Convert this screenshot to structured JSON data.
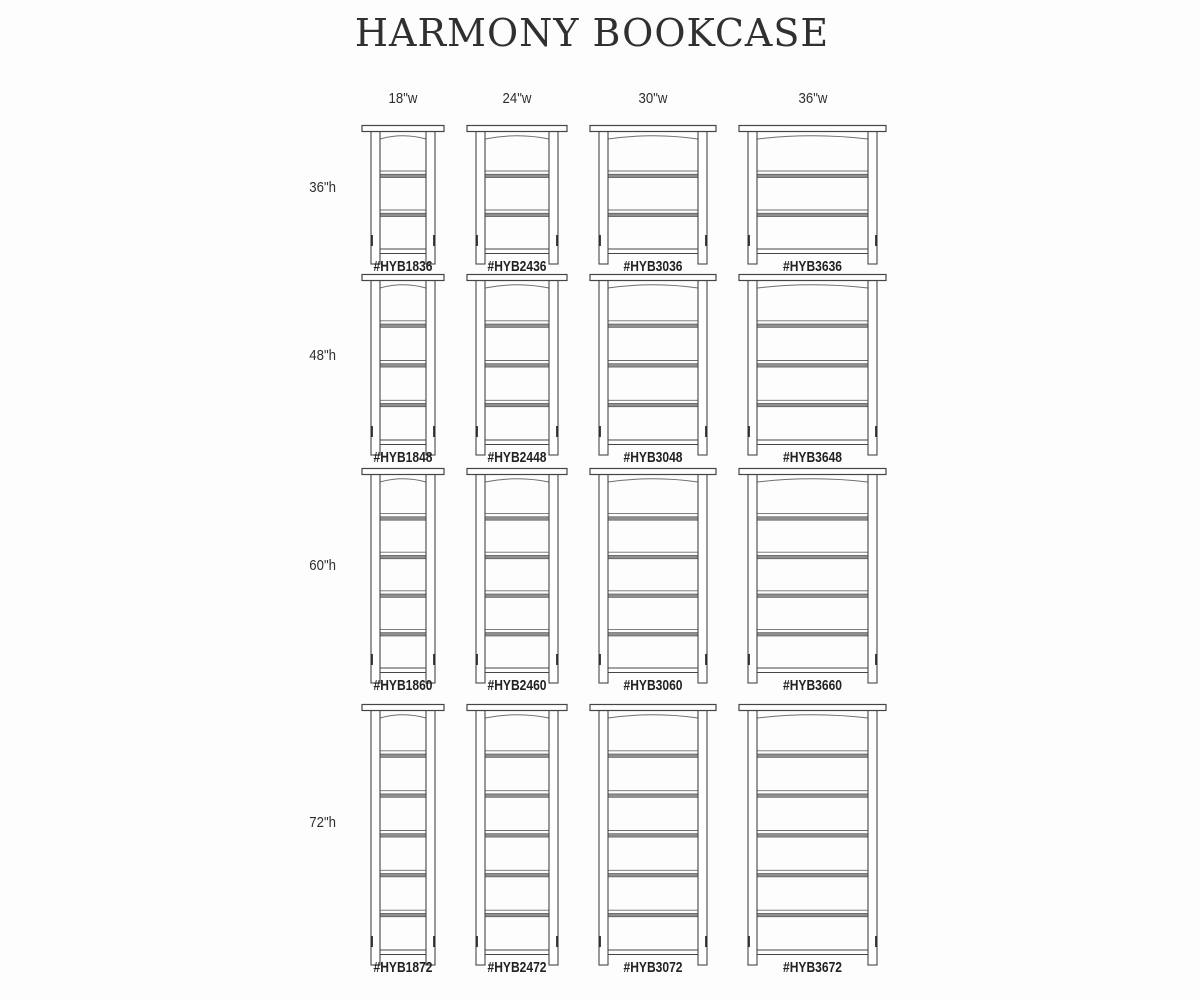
{
  "title": "HARMONY BOOKCASE",
  "grid": {
    "columns": [
      {
        "label": "18\"w",
        "width_in": 18
      },
      {
        "label": "24\"w",
        "width_in": 24
      },
      {
        "label": "30\"w",
        "width_in": 30
      },
      {
        "label": "36\"w",
        "width_in": 36
      }
    ],
    "rows": [
      {
        "label": "36\"h",
        "height_in": 36,
        "shelf_count": 2
      },
      {
        "label": "48\"h",
        "height_in": 48,
        "shelf_count": 3
      },
      {
        "label": "60\"h",
        "height_in": 60,
        "shelf_count": 4
      },
      {
        "label": "72\"h",
        "height_in": 72,
        "shelf_count": 5
      }
    ],
    "models": [
      [
        "#HYB1836",
        "#HYB2436",
        "#HYB3036",
        "#HYB3636"
      ],
      [
        "#HYB1848",
        "#HYB2448",
        "#HYB3048",
        "#HYB3648"
      ],
      [
        "#HYB1860",
        "#HYB2460",
        "#HYB3060",
        "#HYB3660"
      ],
      [
        "#HYB1872",
        "#HYB2472",
        "#HYB3072",
        "#HYB3672"
      ]
    ]
  },
  "colors": {
    "line": "#454545",
    "light_line": "#6e6e6e",
    "shelf_fill": "#8f8f8f",
    "text": "#222222",
    "title_text": "#30302f",
    "background": "#fdfdfd"
  }
}
